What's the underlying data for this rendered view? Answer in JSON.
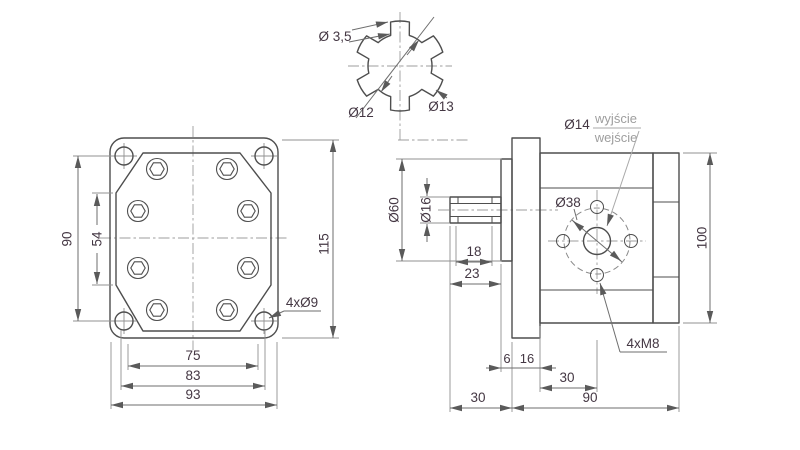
{
  "drawing": {
    "front_view": {
      "dim_hole_spacing_v": "90",
      "dim_body_flat": "54",
      "dim_flange_height": "115",
      "dim_width_1": "75",
      "dim_width_2": "83",
      "dim_width_3": "93",
      "corner_holes_label": "4xØ9"
    },
    "spline_detail": {
      "tooth_width": "Ø 3,5",
      "root_diameter": "Ø12",
      "outer_diameter": "Ø13"
    },
    "side_view": {
      "hub_diameter": "Ø60",
      "shaft_diameter": "Ø16",
      "spline_length": "18",
      "shaft_length": "23",
      "port_diameter": "Ø14",
      "port_out": "wyjście",
      "port_in": "wejście",
      "bolt_circle": "Ø38",
      "body_height": "100",
      "port_holes_label": "4xM8",
      "hub_width": "6",
      "flange_thickness": "16",
      "shaft_overall": "30",
      "port_offset": "30",
      "body_length": "90"
    },
    "colors": {
      "outline": "#4e4e4e",
      "dimension": "#6e6e6e",
      "text": "#443743",
      "light_text": "#9e9e9e",
      "background": "#ffffff"
    }
  }
}
